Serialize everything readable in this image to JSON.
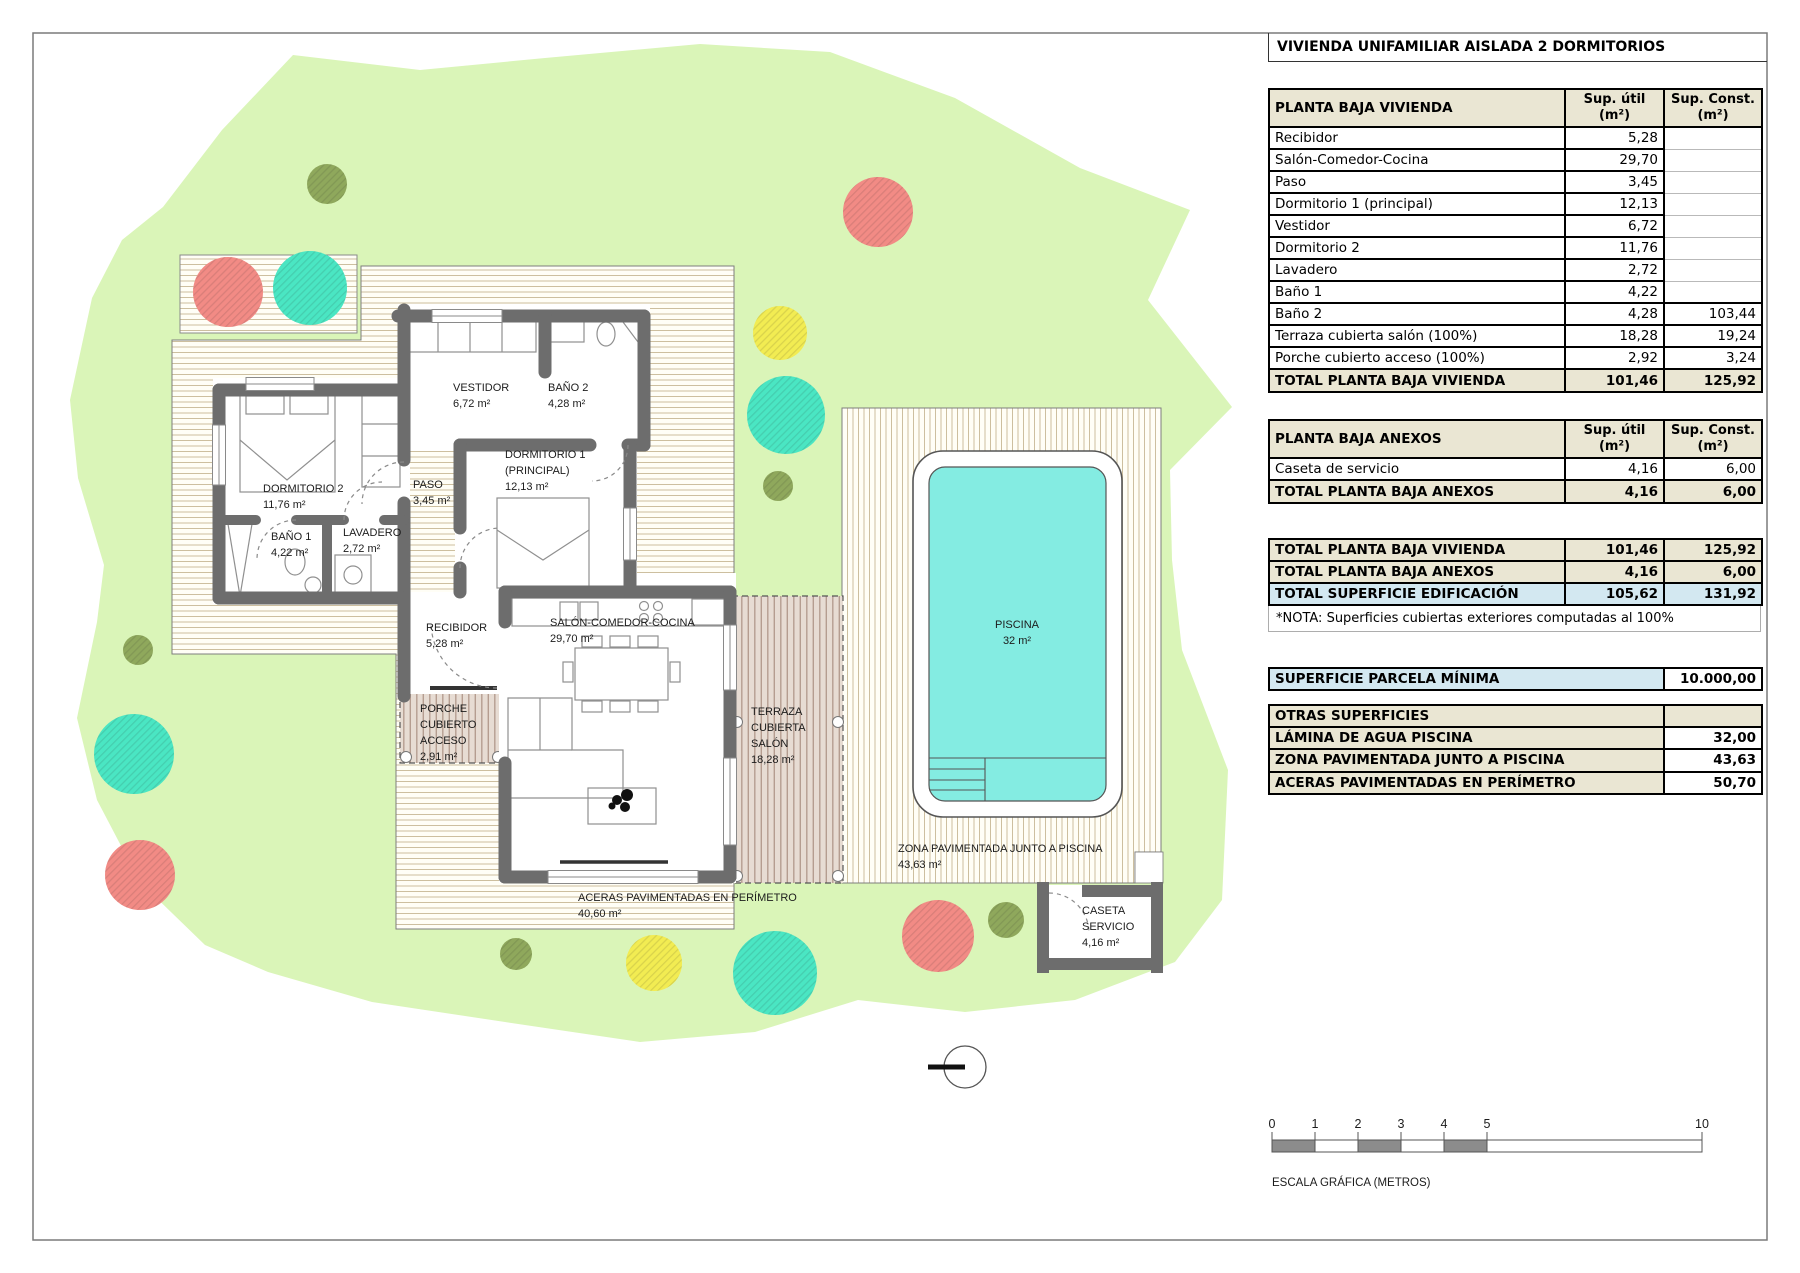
{
  "header": {
    "title": "VIVIENDA UNIFAMILIAR AISLADA 2 DORMITORIOS"
  },
  "colors": {
    "parcel_green": "#daf5b8",
    "pool_water": "#84ece2",
    "wall_gray": "#6d6d6d",
    "table_beige": "#eae6d3",
    "table_blue": "#d3e8f1",
    "tree_red": "#f28b85",
    "tree_turquoise": "#4ae6c3",
    "tree_yellow": "#f2ec52",
    "tree_olive": "#8fa85c"
  },
  "tables": {
    "vivienda": {
      "header": [
        "PLANTA BAJA VIVIENDA",
        "Sup. útil (m²)",
        "Sup. Const. (m²)"
      ],
      "rows": [
        [
          "Recibidor",
          "5,28",
          ""
        ],
        [
          "Salón-Comedor-Cocina",
          "29,70",
          ""
        ],
        [
          "Paso",
          "3,45",
          ""
        ],
        [
          "Dormitorio 1 (principal)",
          "12,13",
          ""
        ],
        [
          "Vestidor",
          "6,72",
          ""
        ],
        [
          "Dormitorio 2",
          "11,76",
          ""
        ],
        [
          "Lavadero",
          "2,72",
          ""
        ],
        [
          "Baño 1",
          "4,22",
          ""
        ],
        [
          "Baño 2",
          "4,28",
          "103,44"
        ],
        [
          "Terraza cubierta salón (100%)",
          "18,28",
          "19,24"
        ],
        [
          "Porche cubierto acceso (100%)",
          "2,92",
          "3,24"
        ]
      ],
      "total": [
        "TOTAL PLANTA BAJA VIVIENDA",
        "101,46",
        "125,92"
      ]
    },
    "anexos": {
      "header": [
        "PLANTA BAJA ANEXOS",
        "Sup. útil (m²)",
        "Sup. Const. (m²)"
      ],
      "rows": [
        [
          "Caseta de servicio",
          "4,16",
          "6,00"
        ]
      ],
      "total": [
        "TOTAL PLANTA BAJA ANEXOS",
        "4,16",
        "6,00"
      ]
    },
    "resumen": {
      "rows": [
        {
          "label": "TOTAL PLANTA BAJA VIVIENDA",
          "util": "101,46",
          "const": "125,92",
          "style": "beige"
        },
        {
          "label": "TOTAL PLANTA BAJA ANEXOS",
          "util": "4,16",
          "const": "6,00",
          "style": "beige"
        },
        {
          "label": "TOTAL SUPERFICIE EDIFICACIÓN",
          "util": "105,62",
          "const": "131,92",
          "style": "blue"
        }
      ]
    },
    "nota": "*NOTA: Superficies cubiertas exteriores computadas al 100%",
    "parcela": {
      "label": "SUPERFICIE PARCELA MÍNIMA",
      "value": "10.000,00"
    },
    "otras": {
      "header": "OTRAS SUPERFICIES",
      "rows": [
        [
          "LÁMINA DE AGUA PISCINA",
          "32,00"
        ],
        [
          "ZONA PAVIMENTADA JUNTO A PISCINA",
          "43,63"
        ],
        [
          "ACERAS PAVIMENTADAS EN PERÍMETRO",
          "50,70"
        ]
      ]
    }
  },
  "plan": {
    "labels": [
      {
        "x": 453,
        "y": 391,
        "lines": [
          "VESTIDOR",
          "6,72 m²"
        ]
      },
      {
        "x": 548,
        "y": 391,
        "lines": [
          "BAÑO 2",
          "4,28 m²"
        ]
      },
      {
        "x": 505,
        "y": 458,
        "lines": [
          "DORMITORIO 1",
          "(PRINCIPAL)",
          "12,13 m²"
        ]
      },
      {
        "x": 263,
        "y": 492,
        "lines": [
          "DORMITORIO 2",
          "11,76 m²"
        ]
      },
      {
        "x": 413,
        "y": 488,
        "lines": [
          "PASO",
          "3,45 m²"
        ]
      },
      {
        "x": 271,
        "y": 540,
        "lines": [
          "BAÑO 1",
          "4,22 m²"
        ]
      },
      {
        "x": 343,
        "y": 536,
        "lines": [
          "LAVADERO",
          "2,72 m²"
        ]
      },
      {
        "x": 426,
        "y": 631,
        "lines": [
          "RECIBIDOR",
          "5,28 m²"
        ]
      },
      {
        "x": 550,
        "y": 626,
        "lines": [
          "SALÓN-COMEDOR-COCINA",
          "29,70 m²"
        ]
      },
      {
        "x": 420,
        "y": 712,
        "lines": [
          "PORCHE",
          "CUBIERTO",
          "ACCESO",
          "2,91 m²"
        ]
      },
      {
        "x": 751,
        "y": 715,
        "lines": [
          "TERRAZA",
          "CUBIERTA",
          "SALÓN",
          "18,28 m²"
        ]
      },
      {
        "x": 578,
        "y": 901,
        "lines": [
          "ACERAS PAVIMENTADAS EN PERÍMETRO",
          "40,60 m²"
        ]
      },
      {
        "x": 1017,
        "y": 628,
        "anchor": "middle",
        "lines": [
          "PISCINA",
          "32 m²"
        ]
      },
      {
        "x": 898,
        "y": 852,
        "lines": [
          "ZONA PAVIMENTADA JUNTO A PISCINA",
          "43,63 m²"
        ]
      },
      {
        "x": 1082,
        "y": 914,
        "lines": [
          "CASETA",
          "SERVICIO",
          "4,16 m²"
        ]
      }
    ]
  },
  "scale_bar": {
    "ticks": [
      {
        "m": 0,
        "label": "0"
      },
      {
        "m": 1,
        "label": "1"
      },
      {
        "m": 2,
        "label": "2"
      },
      {
        "m": 3,
        "label": "3"
      },
      {
        "m": 4,
        "label": "4"
      },
      {
        "m": 5,
        "label": "5"
      },
      {
        "m": 10,
        "label": "10"
      }
    ],
    "dark_segments": [
      [
        0,
        1
      ],
      [
        2,
        3
      ],
      [
        4,
        5
      ]
    ],
    "label": "ESCALA GRÁFICA (METROS)"
  }
}
